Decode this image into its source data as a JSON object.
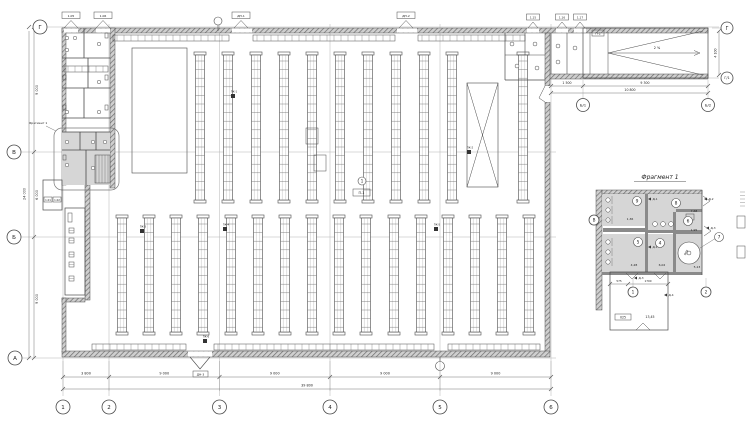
{
  "sheet": {
    "fragment_callout_label": "Фрагмент 1",
    "line_color": "#4a4a4a",
    "axis_color": "#b5b5b5",
    "room_fill": "#d6d6d6"
  },
  "main_plan": {
    "axes_bottom": [
      "1",
      "2",
      "3",
      "4",
      "5",
      "6"
    ],
    "axes_left": [
      "Г",
      "В",
      "Б",
      "А"
    ],
    "dims_bottom": [
      "3 800",
      "9 000",
      "9 000",
      "9 000",
      "9 000"
    ],
    "dims_bottom_total": "39 800",
    "dims_left": [
      "9 000",
      "6 000",
      "9 000"
    ],
    "dims_left_total": "24 000",
    "center_tag": {
      "circle": "1",
      "box": "П-1"
    },
    "door_tags": {
      "annex_top": [
        "1.05",
        "1.06"
      ],
      "hall_top": [
        "ДН-1",
        "ДН-2"
      ],
      "right_top": [
        "1.15",
        "1.16",
        "1.17"
      ],
      "bottom": [
        "ДН-3"
      ],
      "vestibule": [
        "1.01",
        "1.02"
      ]
    },
    "markers": [
      "ПК-1",
      "ПК-2",
      "ПК-3",
      "ПК-4",
      "ПК-5",
      "ПК-6"
    ]
  },
  "ramp": {
    "slope_label": "2 %",
    "tag": "П-2",
    "axis_top_right": "Г",
    "axis_bottom_right": "Г/1",
    "axis_b1": "Б/1",
    "axis_b2": "Б/2",
    "dims": [
      "1 500",
      "9 300"
    ],
    "dims_total": "10 800",
    "side_dim": "4 100"
  },
  "fragment": {
    "title": "Фрагмент 1",
    "axis_left": "В",
    "axes_bottom": [
      "1",
      "2"
    ],
    "rooms": [
      {
        "num": "9",
        "area": "1,36"
      },
      {
        "num": "8",
        "area": "7,68"
      },
      {
        "num": "5",
        "area": "4,28"
      },
      {
        "num": "4",
        "area": "6,02"
      },
      {
        "num": "6",
        "area": "1,95"
      },
      {
        "num": "7",
        "area": "5,13"
      }
    ],
    "tank_label": "900",
    "bottom_room_area": "13,45",
    "bottom_room_tag": "025",
    "door_tags": [
      "Д-1",
      "Д-2",
      "Д-3",
      "Д-4"
    ],
    "dims": [
      "575",
      "1700"
    ]
  }
}
